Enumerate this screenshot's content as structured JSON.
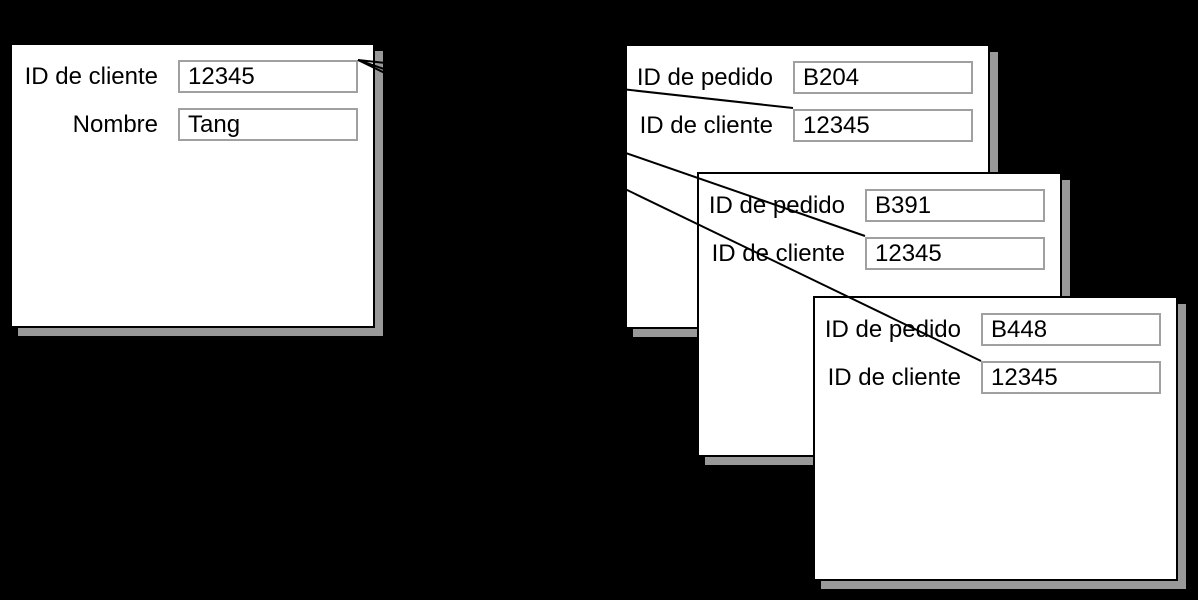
{
  "diagram": {
    "description": "Customer record linked to three order records",
    "colors": {
      "background": "#000000",
      "card_background": "#ffffff",
      "card_border": "#000000",
      "card_shadow": "#999999",
      "field_border": "#a0a0a0",
      "link_line": "#000000"
    },
    "customer_card": {
      "fields": [
        {
          "label": "ID de cliente",
          "value": "12345"
        },
        {
          "label": "Nombre",
          "value": "Tang"
        }
      ]
    },
    "order_cards": [
      {
        "fields": [
          {
            "label": "ID de pedido",
            "value": "B204"
          },
          {
            "label": "ID de cliente",
            "value": "12345"
          }
        ]
      },
      {
        "fields": [
          {
            "label": "ID de pedido",
            "value": "B391"
          },
          {
            "label": "ID de cliente",
            "value": "12345"
          }
        ]
      },
      {
        "fields": [
          {
            "label": "ID de pedido",
            "value": "B448"
          },
          {
            "label": "ID de cliente",
            "value": "12345"
          }
        ]
      }
    ]
  }
}
